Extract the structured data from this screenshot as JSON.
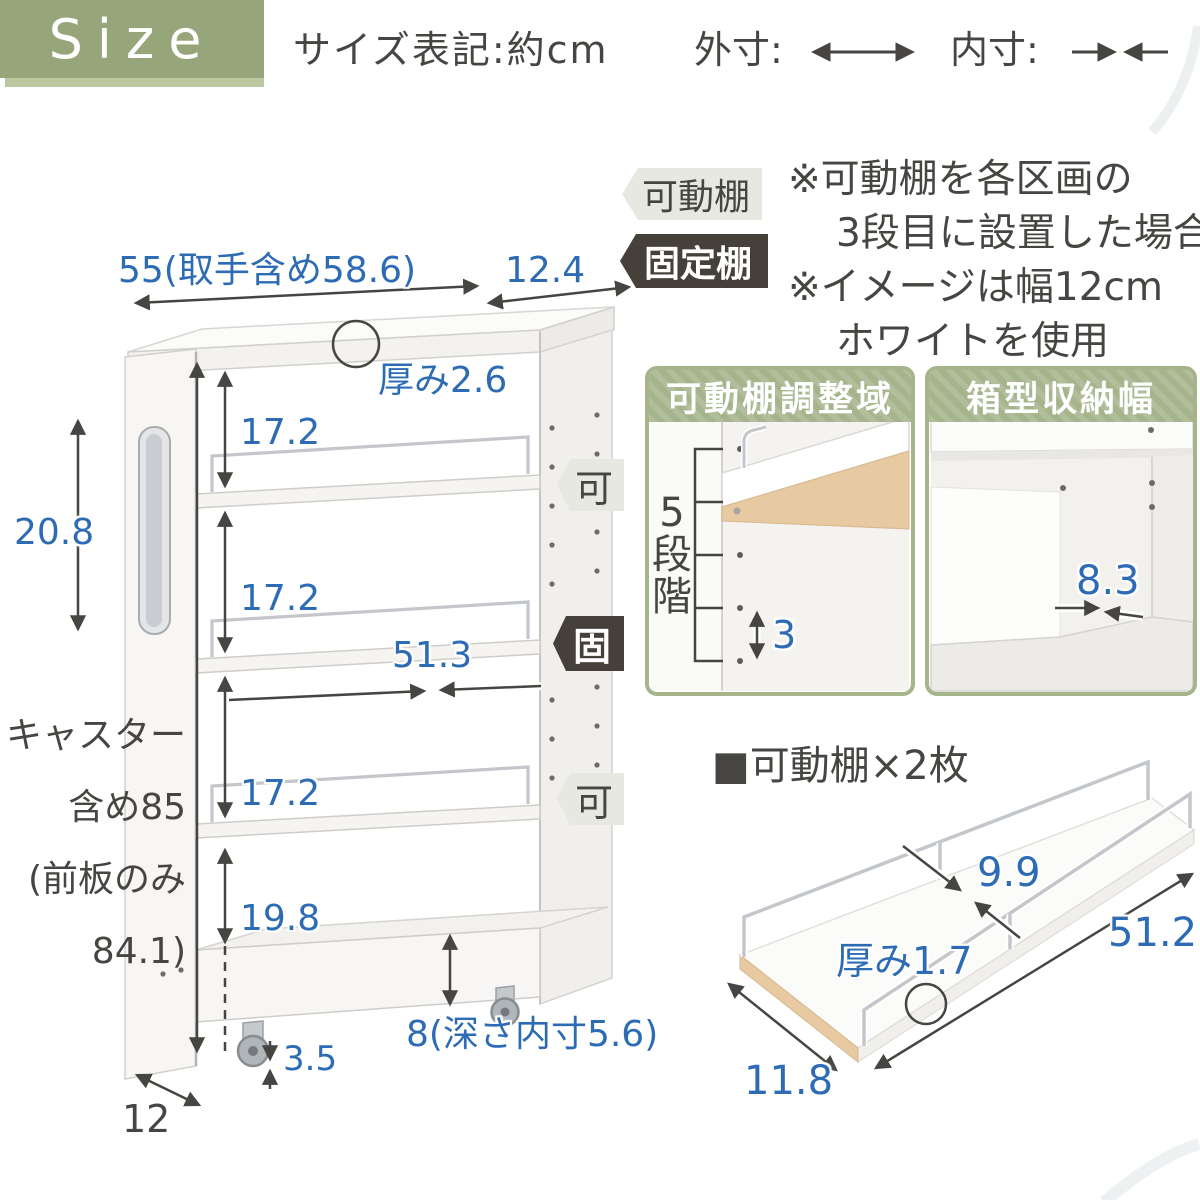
{
  "header": {
    "badge": "Size",
    "notation": "サイズ表記:約cm",
    "outer_label": "外寸:",
    "inner_label": "内寸:"
  },
  "legend": {
    "movable_tag": "可動棚",
    "fixed_tag": "固定棚",
    "note1_line1": "※可動棚を各区画の",
    "note1_line2": "3段目に設置した場合",
    "note2_line1": "※イメージは幅12cm",
    "note2_line2": "ホワイトを使用"
  },
  "cart": {
    "total_width": "55(取手含め58.6)",
    "top_depth": "12.4",
    "top_thickness": "厚み2.6",
    "gap1": "17.2",
    "handle_height": "20.8",
    "gap2": "17.2",
    "inner_width": "51.3",
    "gap3": "17.2",
    "gap4": "19.8",
    "height_line1": "キャスター",
    "height_line2": "含め85",
    "height_line3": "(前板のみ",
    "height_line4": "84.1)",
    "caster_height": "3.5",
    "box_depth": "8(深さ内寸5.6)",
    "base_depth": "12",
    "movable_short": "可",
    "fixed_short": "固"
  },
  "panel_adjust": {
    "title": "可動棚調整域",
    "steps": [
      "5",
      "段",
      "階"
    ],
    "pitch": "3"
  },
  "panel_box": {
    "title": "箱型収納幅",
    "width": "8.3"
  },
  "shelf_figure": {
    "title": "■可動棚×2枚",
    "width": "9.9",
    "length": "51.2",
    "thickness": "厚み1.7",
    "depth": "11.8"
  },
  "colors": {
    "accent_green": "#97a57a",
    "panel_green": "#a6b48c",
    "dim_blue": "#2d6cb4",
    "ink": "#474541",
    "tag_dark": "#45403a",
    "tag_light": "#e8e8e2"
  }
}
